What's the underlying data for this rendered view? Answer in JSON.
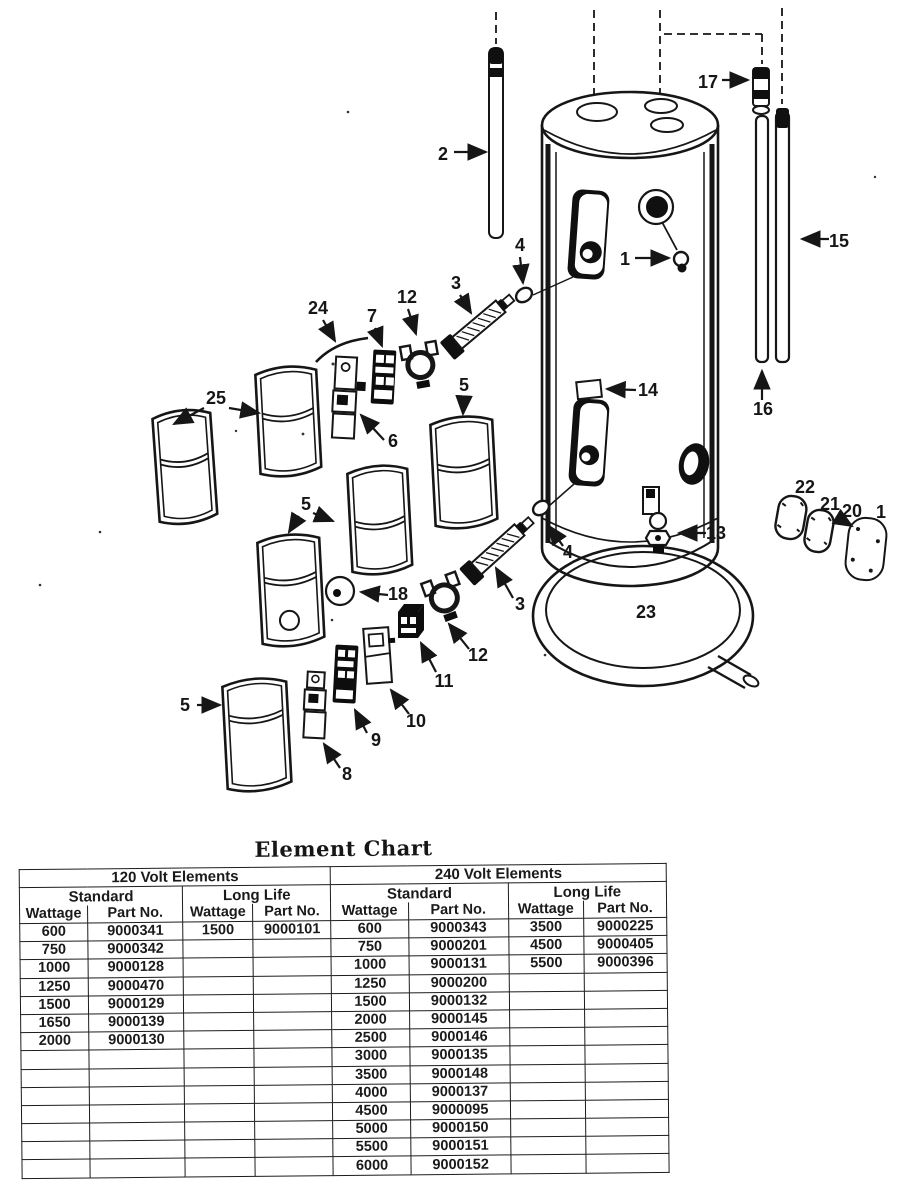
{
  "diagram": {
    "callouts": [
      "2",
      "17",
      "15",
      "16",
      "1",
      "4",
      "3",
      "12",
      "7",
      "24",
      "25",
      "5",
      "6",
      "5",
      "18",
      "12",
      "3",
      "4",
      "11",
      "10",
      "9",
      "8",
      "5",
      "13",
      "14",
      "23",
      "22",
      "21",
      "20",
      "1"
    ]
  },
  "element_chart": {
    "title": "Element Chart",
    "sections": [
      "120 Volt Elements",
      "240 Volt Elements"
    ],
    "subsections": [
      "Standard",
      "Long Life",
      "Standard",
      "Long Life"
    ],
    "columns": [
      "Wattage",
      "Part No.",
      "Wattage",
      "Part No.",
      "Wattage",
      "Part No.",
      "Wattage",
      "Part No."
    ],
    "rows": [
      [
        "600",
        "9000341",
        "1500",
        "9000101",
        "600",
        "9000343",
        "3500",
        "9000225"
      ],
      [
        "750",
        "9000342",
        "",
        "",
        "750",
        "9000201",
        "4500",
        "9000405"
      ],
      [
        "1000",
        "9000128",
        "",
        "",
        "1000",
        "9000131",
        "5500",
        "9000396"
      ],
      [
        "1250",
        "9000470",
        "",
        "",
        "1250",
        "9000200",
        "",
        ""
      ],
      [
        "1500",
        "9000129",
        "",
        "",
        "1500",
        "9000132",
        "",
        ""
      ],
      [
        "1650",
        "9000139",
        "",
        "",
        "2000",
        "9000145",
        "",
        ""
      ],
      [
        "2000",
        "9000130",
        "",
        "",
        "2500",
        "9000146",
        "",
        ""
      ],
      [
        "",
        "",
        "",
        "",
        "3000",
        "9000135",
        "",
        ""
      ],
      [
        "",
        "",
        "",
        "",
        "3500",
        "9000148",
        "",
        ""
      ],
      [
        "",
        "",
        "",
        "",
        "4000",
        "9000137",
        "",
        ""
      ],
      [
        "",
        "",
        "",
        "",
        "4500",
        "9000095",
        "",
        ""
      ],
      [
        "",
        "",
        "",
        "",
        "5000",
        "9000150",
        "",
        ""
      ],
      [
        "",
        "",
        "",
        "",
        "5500",
        "9000151",
        "",
        ""
      ],
      [
        "",
        "",
        "",
        "",
        "6000",
        "9000152",
        "",
        ""
      ]
    ]
  }
}
